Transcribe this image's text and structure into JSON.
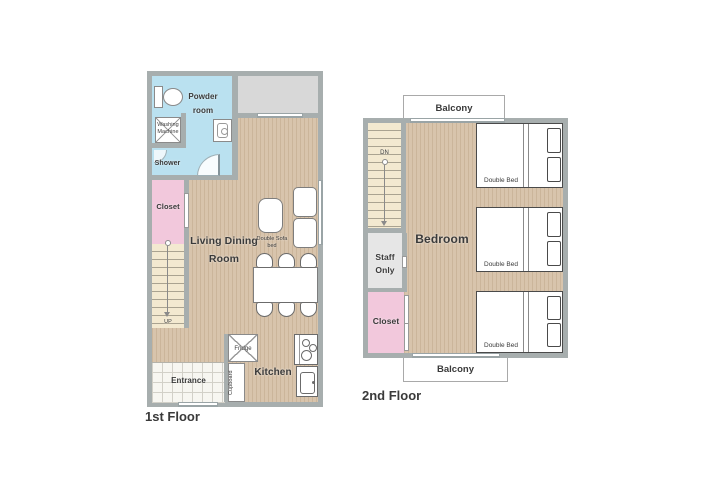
{
  "colors": {
    "wall": "#a7aeae",
    "wood_base": "#d8c4ac",
    "water_blue": "#bae1f0",
    "closet_pink": "#f2c8dc",
    "stair_cream": "#f3e9d0",
    "gray_block": "#d8d8d8",
    "staff_gray": "#e6e6e6",
    "text": "#3a3a3a"
  },
  "floor1": {
    "title": "1st Floor",
    "powder_room": "Powder room",
    "washing_machine": "Washing Machine",
    "shower": "Shower",
    "closet": "Closet",
    "stairs_up": "UP",
    "living_dining": "Living Dining Room",
    "sofa_bed": "Double Sofa bed",
    "fridge": "Fridge",
    "cupboard": "Cupboard",
    "kitchen": "Kitchen",
    "entrance": "Entrance"
  },
  "floor2": {
    "title": "2nd Floor",
    "balcony_top": "Balcony",
    "balcony_bottom": "Balcony",
    "stairs_down": "DN",
    "bedroom": "Bedroom",
    "staff_only": "Staff Only",
    "closet": "Closet",
    "beds": [
      {
        "label": "Double Bed"
      },
      {
        "label": "Double Bed"
      },
      {
        "label": "Double Bed"
      }
    ]
  }
}
